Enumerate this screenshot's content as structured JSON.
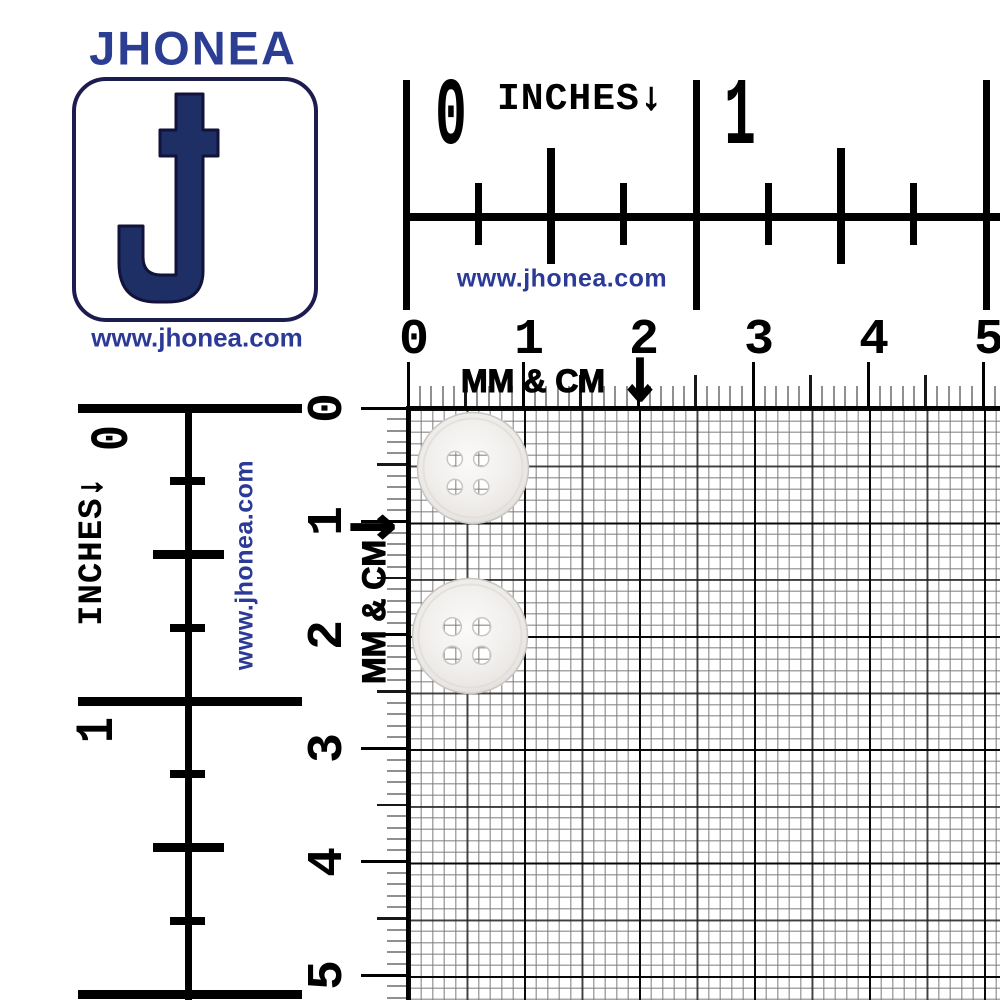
{
  "meta": {
    "description": "JHONEA 4-hole button product photo on mm/cm and inches measurement grid"
  },
  "brand": {
    "name": "JHONEA",
    "url": "www.jhonea.com",
    "letter": "J"
  },
  "colors": {
    "navy_text": "#2c3e94",
    "logo_fill": "#1e2f66",
    "logo_outline": "#12123a",
    "logo_border": "#1c1c4e",
    "url_blue": "#2b3a96",
    "tick_black": "#000000",
    "tick_half": "#181818",
    "tick_minor": "#909090",
    "button_face_light": "#fbfaf9",
    "button_face_mid": "#f0eeec",
    "button_face_dark": "#d9d6d2",
    "button_stroke": "#c9c6c1"
  },
  "rulers": {
    "inches_top": {
      "title": "INCHES",
      "arrow": "↓",
      "numbers": [
        "0",
        "1"
      ],
      "url": "www.jhonea.com"
    },
    "inches_left": {
      "title": "INCHES",
      "arrow": "↓",
      "numbers": [
        "0",
        "1"
      ],
      "url": "www.jhonea.com"
    },
    "mm_top": {
      "title": "MM & CM",
      "arrow": "↓",
      "numbers": [
        "0",
        "1",
        "2",
        "3",
        "4",
        "5"
      ]
    },
    "mm_left": {
      "title": "MM & CM",
      "arrow": "↓",
      "numbers": [
        "0",
        "1",
        "2",
        "3",
        "4",
        "5"
      ]
    }
  },
  "buttons": {
    "label": "4-hole round sewing button",
    "items": [
      {
        "cx": 473,
        "cy": 468,
        "r": 55.5,
        "hole_cx": 468,
        "hole_cy": 473,
        "hole_dx": 13.2,
        "hole_dy": 14.0,
        "hole_r": 7.6
      },
      {
        "cx": 470,
        "cy": 636,
        "r": 57.5,
        "hole_cx": 467,
        "hole_cy": 641,
        "hole_dx": 14.7,
        "hole_dy": 14.2,
        "hole_r": 9.0
      }
    ]
  }
}
